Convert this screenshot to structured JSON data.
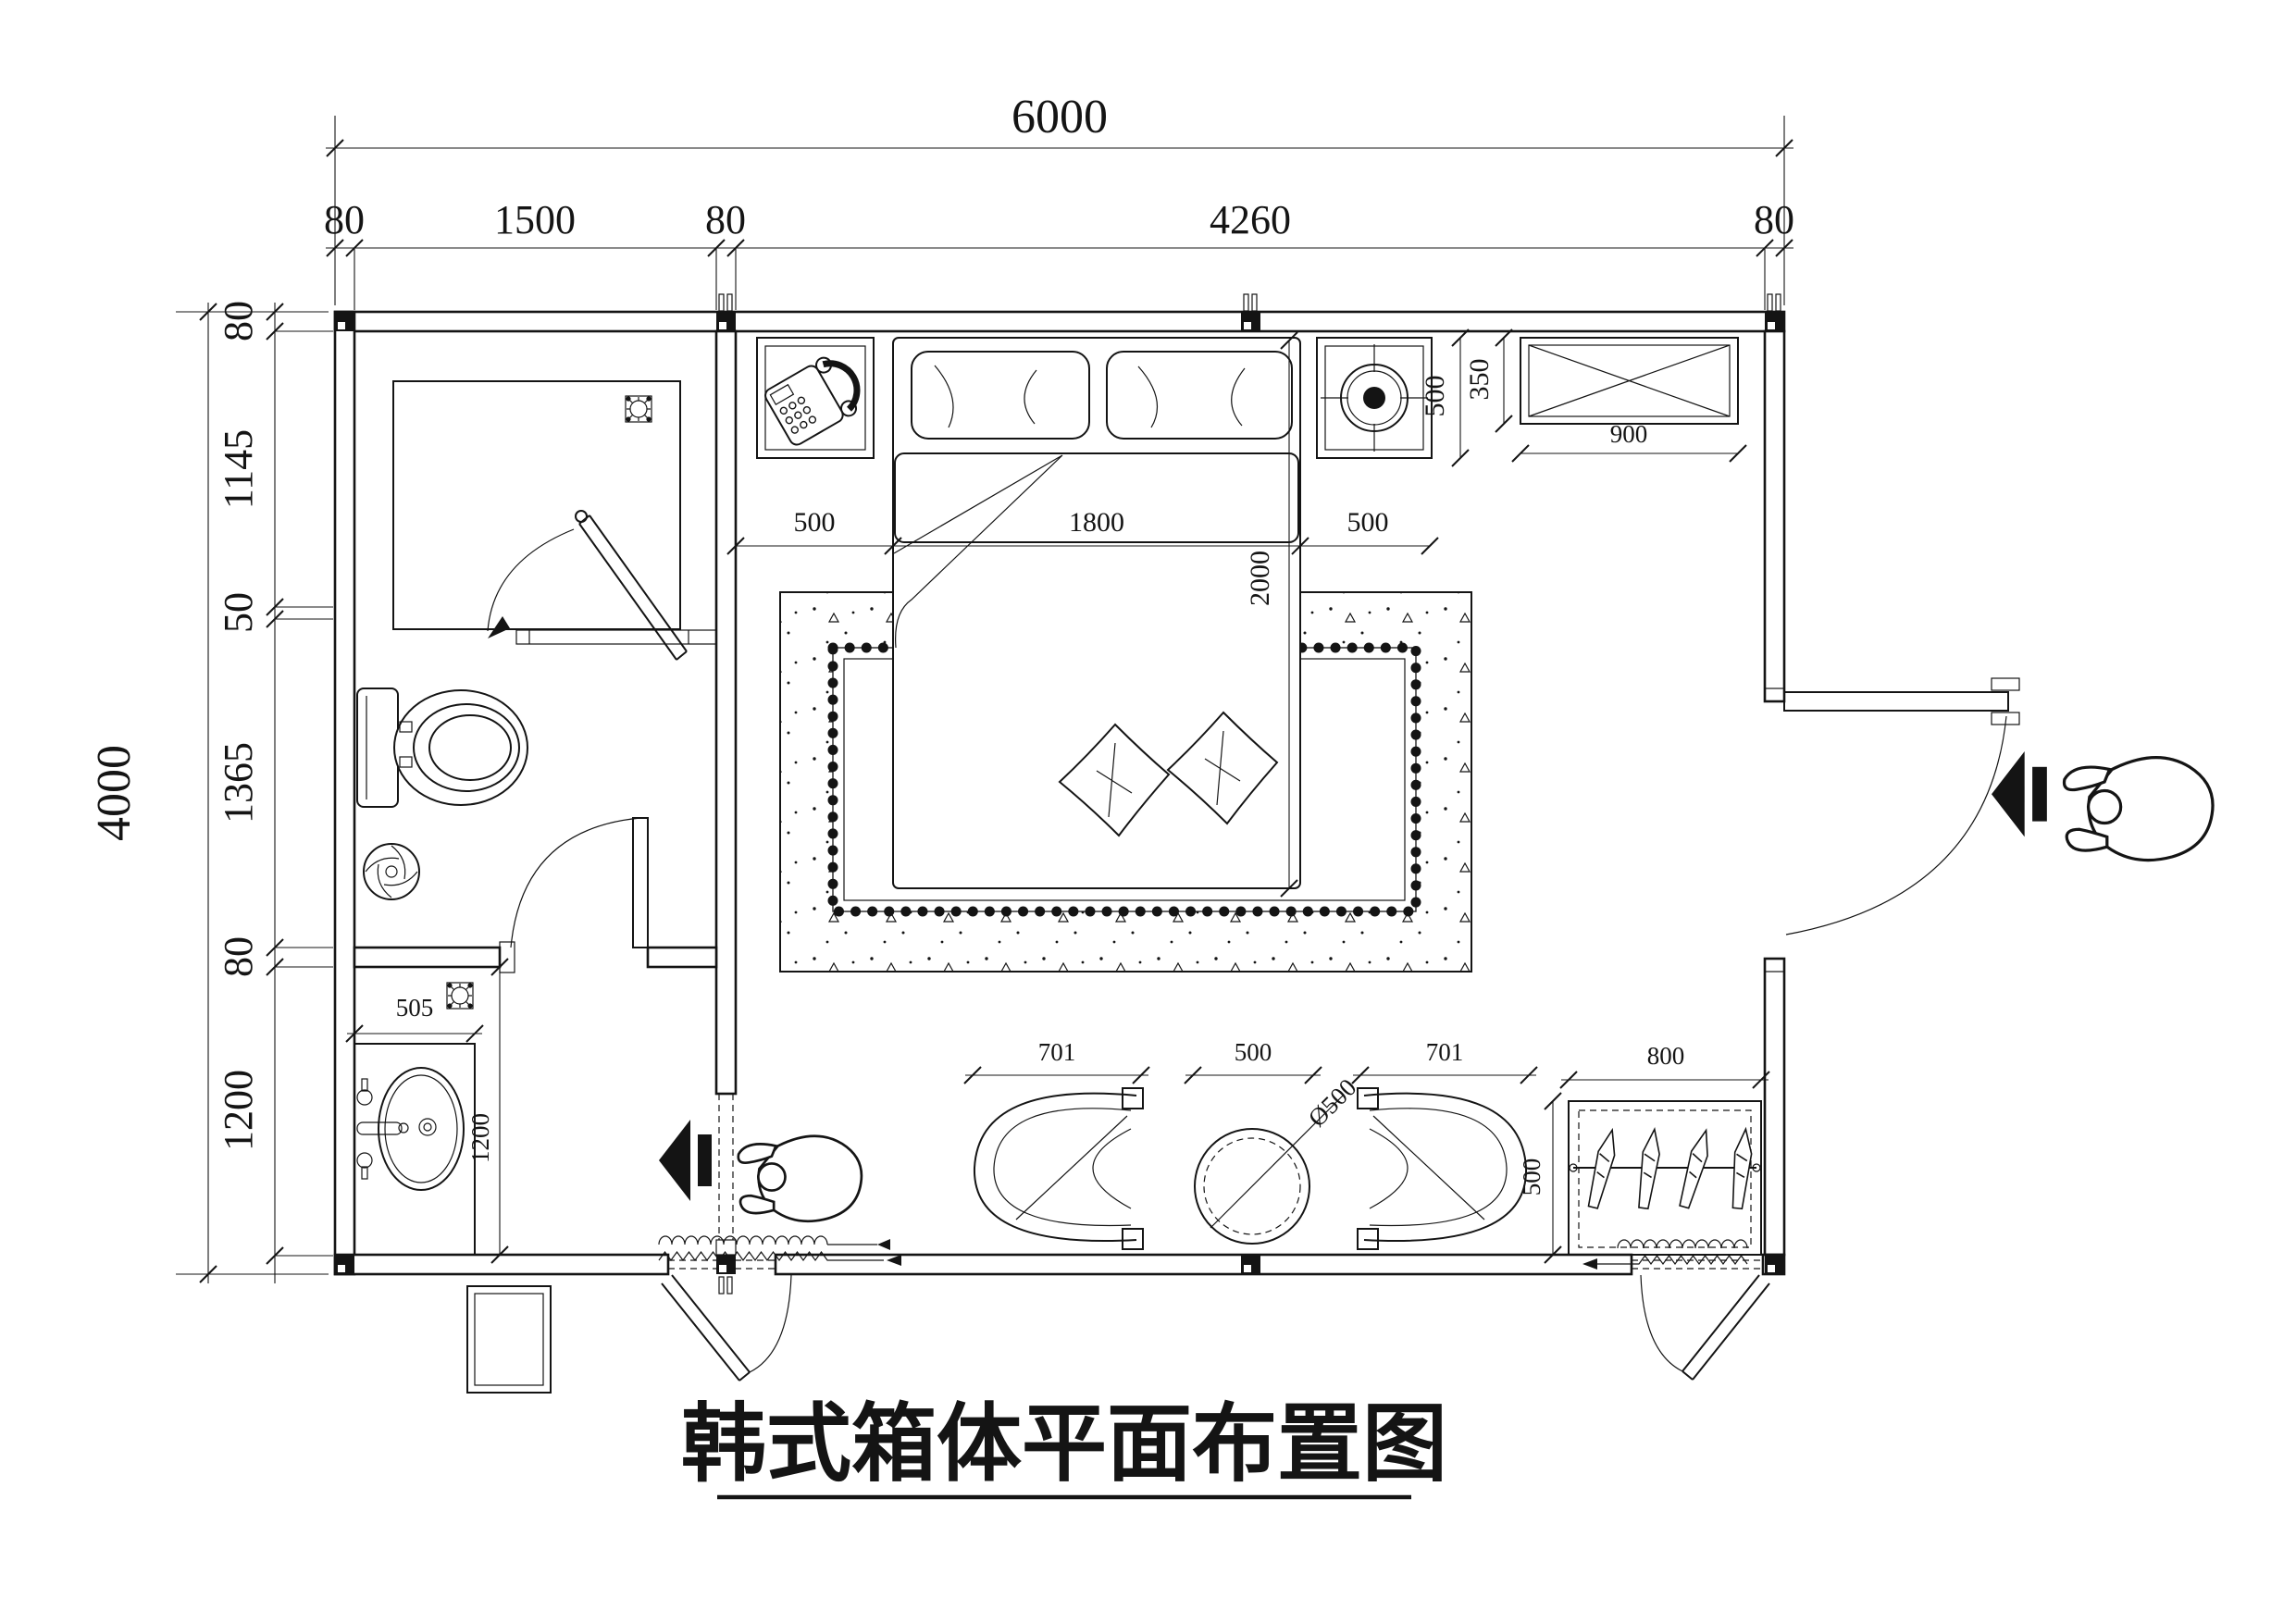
{
  "title": "韩式箱体平面布置图",
  "dimensions": {
    "top": {
      "total": "6000",
      "segments": [
        "80",
        "1500",
        "80",
        "4260",
        "80"
      ]
    },
    "left": {
      "total": "4000",
      "segments": [
        "80",
        "1145",
        "50",
        "1365",
        "80",
        "1200"
      ]
    },
    "bed": {
      "left_gap": "500",
      "width": "1800",
      "right_gap": "500",
      "length": "2000"
    },
    "headboard": {
      "nightstand_depth": "500",
      "cabinet_depth": "350",
      "cabinet_width": "900"
    },
    "bath": {
      "vanity_width": "505",
      "vanity_length": "1200"
    },
    "seating": {
      "left_chair": "701",
      "center_gap": "500",
      "right_chair": "701",
      "table_diameter": "Ø500"
    },
    "wardrobe": {
      "width": "800",
      "depth": "500"
    }
  },
  "icons": {
    "nightstand_left": "telephone-icon",
    "nightstand_right": "ceiling-speaker-icon",
    "shower": "floor-drain-icon",
    "toilet_room": "swirl-drain-icon",
    "vanity": "floor-drain-icon",
    "entry": "direction-arrow-icon",
    "side_door": "direction-arrow-icon"
  }
}
